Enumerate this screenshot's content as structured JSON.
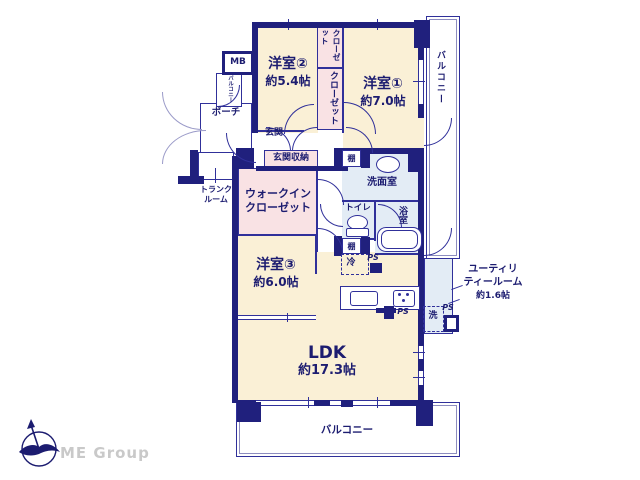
{
  "plan": {
    "rooms": {
      "room1": {
        "name": "洋室①",
        "size": "約7.0帖"
      },
      "room2": {
        "name": "洋室②",
        "size": "約5.4帖"
      },
      "room3": {
        "name": "洋室③",
        "size": "約6.0帖"
      },
      "ldk": {
        "name": "LDK",
        "size": "約17.3帖"
      },
      "utility": {
        "name1": "ユーティリ",
        "name2": "ティールーム",
        "size": "約1.6帖"
      },
      "washroom": "洗面室",
      "bathroom": "浴室",
      "toilet": "トイレ",
      "wic1": "ウォークイン",
      "wic2": "クローゼット",
      "closet_top": "クローゼット",
      "closet_side": "クローゼット",
      "entrance": "玄関",
      "entrance_storage": "玄関収納",
      "porch": "ポーチ",
      "trunk1": "トランク",
      "trunk2": "ルーム",
      "meter_box": "MB"
    },
    "balcony": {
      "right": "バルコニー",
      "bottom": "バルコニー",
      "small": "バルコニー"
    },
    "labels": {
      "shelf": "棚",
      "fridge": "冷",
      "washer": "洗",
      "pipe_space": "PS"
    }
  },
  "watermark": {
    "brand": "ME Group"
  },
  "colors": {
    "wall": "#20207d",
    "room": "#faf0d6",
    "closet": "#f9e2e4",
    "wet": "#e3ecf5",
    "text": "#1c1c70"
  }
}
